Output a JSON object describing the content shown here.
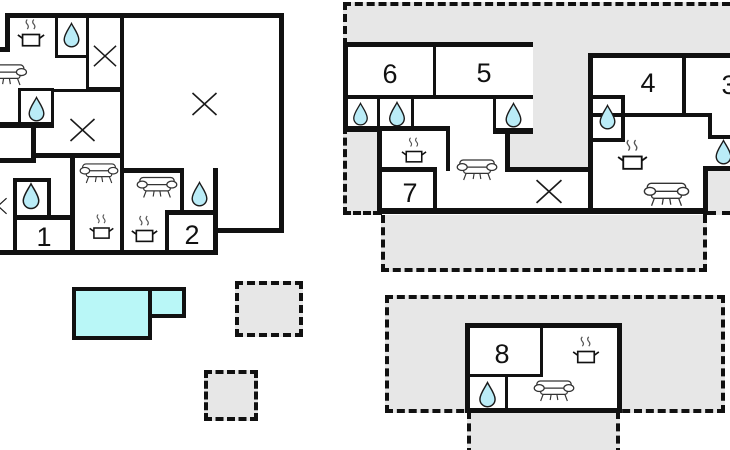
{
  "colors": {
    "wall": "#111111",
    "terrace": "#e7e7e7",
    "water": "#baecf7",
    "pool": "#b9f7f7",
    "line": "#222222"
  },
  "rooms": {
    "r1": "1",
    "r2": "2",
    "r3": "3",
    "r4": "4",
    "r5": "5",
    "r6": "6",
    "r7": "7",
    "r8": "8"
  },
  "icons": {
    "water": "water-drop-icon",
    "kitchen": "stove-pot-icon",
    "sofa": "sofa-icon",
    "window": "window-cross-icon"
  }
}
